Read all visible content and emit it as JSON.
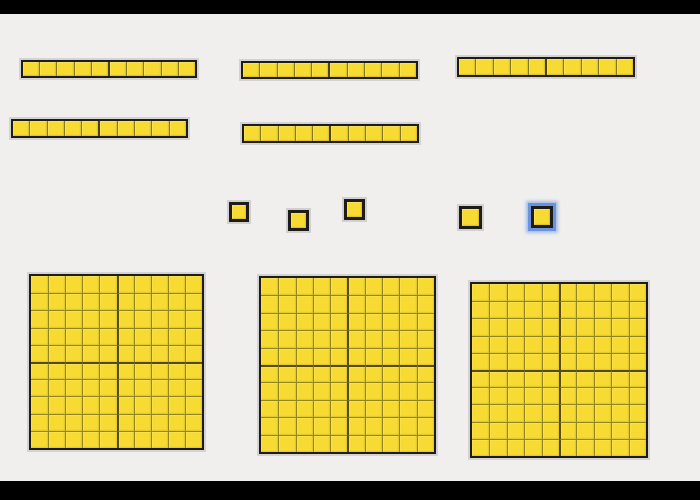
{
  "canvas": {
    "width": 700,
    "height": 500,
    "background": "#f0efee",
    "letterbox": {
      "color": "#000000",
      "top_height": 14,
      "bottom_height": 19
    }
  },
  "colors": {
    "block_fill": "#f7db32",
    "block_border": "#1d1c18",
    "cell_line": "#5f581c",
    "mid_line": "#2a2810",
    "halo": "#b2b2b2",
    "selection": "#6b93dd"
  },
  "counts": {
    "hundreds_flats": 3,
    "tens_rods": 5,
    "ones_units": 5,
    "total_value": 355,
    "selected_piece": "unit-5"
  },
  "pieces": [
    {
      "id": "rod-1",
      "type": "rod",
      "cells": 10,
      "x": 21,
      "y": 60,
      "w": 176,
      "h": 18,
      "selected": false
    },
    {
      "id": "rod-2",
      "type": "rod",
      "cells": 10,
      "x": 241,
      "y": 61,
      "w": 177,
      "h": 18,
      "selected": false
    },
    {
      "id": "rod-3",
      "type": "rod",
      "cells": 10,
      "x": 457,
      "y": 57,
      "w": 178,
      "h": 20,
      "selected": false
    },
    {
      "id": "rod-4",
      "type": "rod",
      "cells": 10,
      "x": 11,
      "y": 119,
      "w": 177,
      "h": 19,
      "selected": false
    },
    {
      "id": "rod-5",
      "type": "rod",
      "cells": 10,
      "x": 242,
      "y": 124,
      "w": 177,
      "h": 19,
      "selected": false
    },
    {
      "id": "unit-1",
      "type": "unit",
      "x": 229,
      "y": 202,
      "w": 20,
      "h": 20,
      "selected": false
    },
    {
      "id": "unit-2",
      "type": "unit",
      "x": 288,
      "y": 210,
      "w": 21,
      "h": 21,
      "selected": false
    },
    {
      "id": "unit-3",
      "type": "unit",
      "x": 344,
      "y": 199,
      "w": 21,
      "h": 21,
      "selected": false
    },
    {
      "id": "unit-4",
      "type": "unit",
      "x": 459,
      "y": 206,
      "w": 23,
      "h": 23,
      "selected": false
    },
    {
      "id": "unit-5",
      "type": "unit",
      "x": 531,
      "y": 206,
      "w": 22,
      "h": 22,
      "selected": true
    },
    {
      "id": "flat-1",
      "type": "flat",
      "rows": 10,
      "cols": 10,
      "x": 29,
      "y": 274,
      "w": 175,
      "h": 176,
      "selected": false
    },
    {
      "id": "flat-2",
      "type": "flat",
      "rows": 10,
      "cols": 10,
      "x": 259,
      "y": 276,
      "w": 177,
      "h": 178,
      "selected": false
    },
    {
      "id": "flat-3",
      "type": "flat",
      "rows": 10,
      "cols": 10,
      "x": 470,
      "y": 282,
      "w": 178,
      "h": 176,
      "selected": false
    }
  ]
}
